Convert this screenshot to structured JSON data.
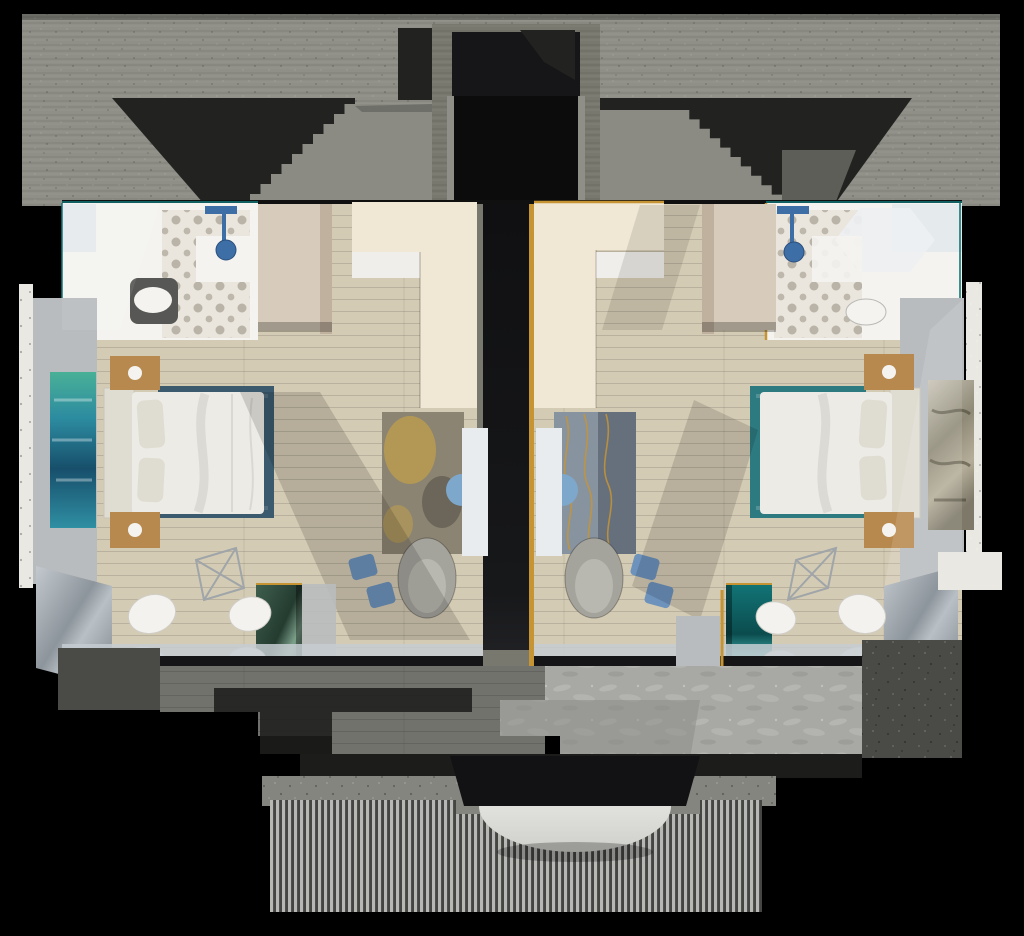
{
  "meta": {
    "title": "Two-suite floor plan - 3D cutaway render",
    "view": "top-down isometric cutaway",
    "render_style": "photoreal architectural visualization",
    "canvas": {
      "width": 1024,
      "height": 936
    }
  },
  "palette": {
    "bg": "#000000",
    "slab": "#8f8f88",
    "slab_dark": "#6e6e66",
    "cavity": "#222220",
    "shaft": "#0c0c0d",
    "stair": "#8b8b84",
    "concrete_mid": "#79786f",
    "spine": "#17181a",
    "gold": "#c79433",
    "cream": "#f0e8d5",
    "marble_white": "#efeeea",
    "wood": "#d4cbb4",
    "white_wall": "#f4f3ef",
    "tile_base": "#eae6dd",
    "tile_ink": "#8f887c",
    "vanity_blue": "#3e6ea6",
    "toilet_mat": "#575755",
    "beige": "#d7ccbb",
    "beige_dark": "#bfb19d",
    "wall_gray": "#b9bcbf",
    "terrazzo": "#eae8e2",
    "art_blue_1": "#49b097",
    "art_blue_2": "#2c8ba0",
    "art_blue_3": "#174f6b",
    "art_gray_1": "#c9c4b6",
    "art_gray_2": "#8f8a77",
    "bed": "#ecebe5",
    "pillow": "#dfdcd2",
    "rug_navy": "#3b5a6d",
    "rug_teal": "#2d7a80",
    "nightstand": "#b8894e",
    "glass": "#9aa2aa",
    "glass_lt": "#c6ccd1",
    "fascia": "#151517",
    "chair_white": "#f3f2ee",
    "armchair": "#a5a49c",
    "rug_l_base": "#8c8472",
    "rug_l_gold": "#c3a149",
    "rug_r_base": "#8893a0",
    "tv_panel": "#e9ecee",
    "tv_blue": "#7ea8cb",
    "stool_blue": "#6d92bc",
    "marble_green": "#3f5f4e",
    "marble_teal": "#127476",
    "deck": "#72726d",
    "deck_dark": "#1c1c1b",
    "water": "#a8a8a4",
    "water_dk": "#8c8c88",
    "speckle": "#85857f",
    "speckle_dk": "#4a4a46",
    "slat_lt": "#b7b7b4",
    "slat_dk": "#454543",
    "disc": "#f3f3f1"
  },
  "scene": {
    "structure": [
      "concrete-roof-slab",
      "stairwell-left",
      "stairwell-right",
      "elevator-shaft",
      "central-spine-wall",
      "slat-facade",
      "canopy-disc",
      "stepped-deck",
      "water-feature"
    ],
    "left_suite": {
      "rooms": [
        "bathroom",
        "bedroom",
        "lounge",
        "balcony"
      ],
      "furniture": [
        "rain-shower",
        "toilet",
        "wardrobe",
        "desk-partition",
        "double-bed",
        "nightstand-pair",
        "wall-art-blue-green",
        "area-rug-navy",
        "lounge-rug-gold",
        "swivel-armchair",
        "tv-panel",
        "side-stools",
        "wireframe-chair",
        "egg-chairs",
        "green-marble-column",
        "glass-wall"
      ]
    },
    "right_suite": {
      "rooms": [
        "bathroom",
        "bedroom",
        "lounge",
        "balcony"
      ],
      "furniture": [
        "rain-shower",
        "toilet",
        "wardrobe",
        "desk-partition-gold-trim",
        "double-bed",
        "nightstand-pair",
        "wall-art-gray-gold",
        "area-rug-teal",
        "lounge-rug-wavy",
        "swivel-armchair",
        "tv-panel",
        "side-stools",
        "wireframe-chair",
        "egg-chairs",
        "teal-marble-column",
        "glass-wall"
      ]
    }
  }
}
